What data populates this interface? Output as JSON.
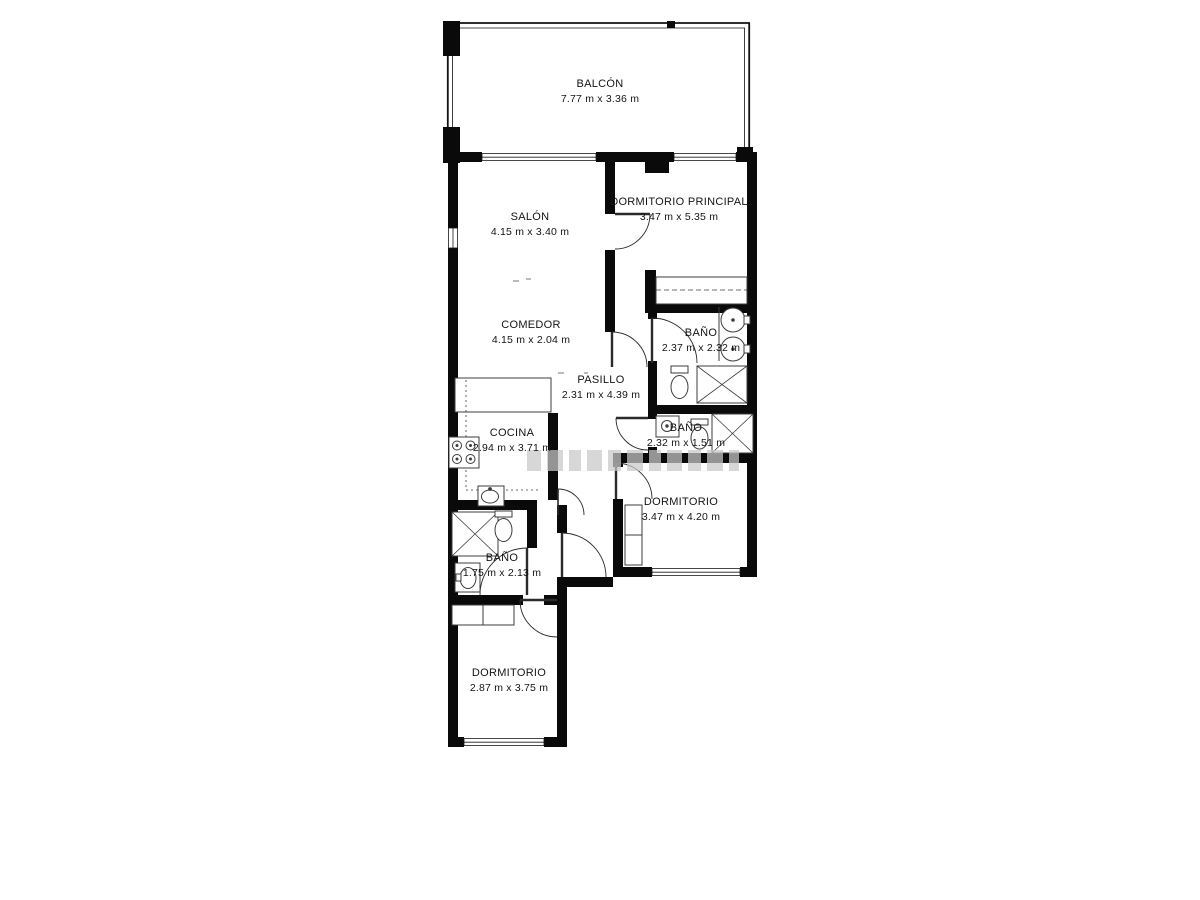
{
  "plan": {
    "type": "apartment-floor-plan",
    "language": "es",
    "rooms": [
      {
        "name": "BALCÓN",
        "dims": "7.77 m x 3.36 m"
      },
      {
        "name": "SALÓN",
        "dims": "4.15 m x 3.40 m"
      },
      {
        "name": "DORMITORIO PRINCIPAL",
        "dims": "3.47 m x 5.35 m"
      },
      {
        "name": "COMEDOR",
        "dims": "4.15 m x 2.04 m"
      },
      {
        "name": "BAÑO",
        "dims": "2.37 m x 2.32 m"
      },
      {
        "name": "PASILLO",
        "dims": "2.31 m x 4.39 m"
      },
      {
        "name": "BAÑO",
        "dims": "2.32 m x 1.51 m"
      },
      {
        "name": "COCINA",
        "dims": "2.94 m x 3.71 m"
      },
      {
        "name": "DORMITORIO",
        "dims": "3.47 m x 4.20 m"
      },
      {
        "name": "BAÑO",
        "dims": "1.75 m x 2.13 m"
      },
      {
        "name": "DORMITORIO",
        "dims": "2.87 m x 3.75 m"
      }
    ],
    "colors": {
      "background": "#ffffff",
      "wall": "#0a0a0a",
      "fixture_line": "#3c3c3c",
      "watermark": "#c9c9c9"
    },
    "watermark": {
      "visible": true
    }
  }
}
